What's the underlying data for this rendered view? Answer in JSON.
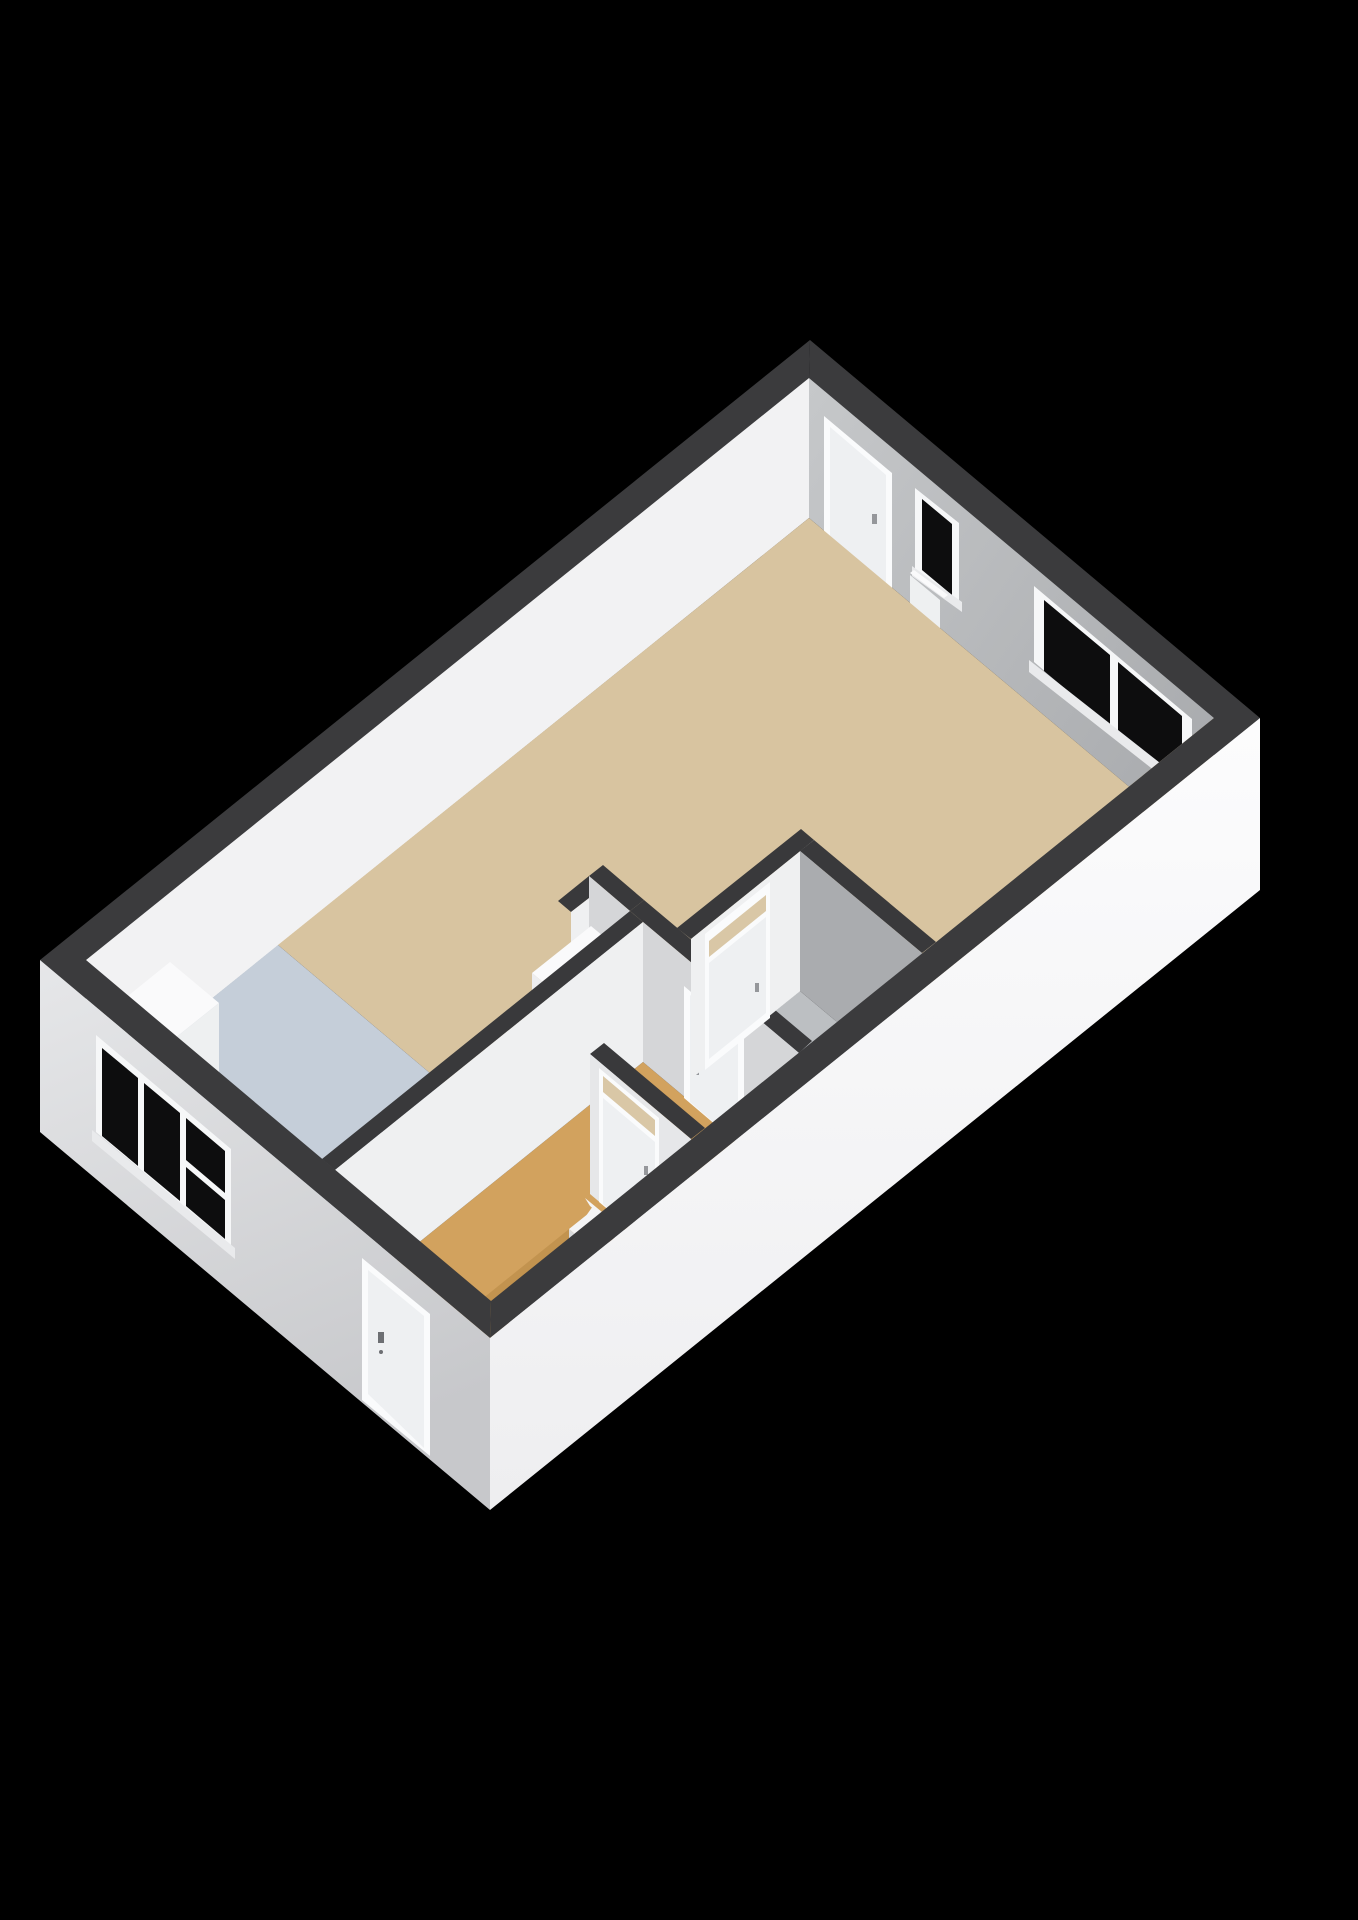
{
  "scene": {
    "type": "3d-floorplan-render",
    "background": "#000000",
    "floors_visible": 1,
    "windows_count": 3,
    "doors_count": 6,
    "transom_doors_count": 2,
    "stair_treads_visible": 7,
    "stair_marker_dots": 2
  },
  "palette": {
    "background": "#000000",
    "wall_top": "#3b3b3d",
    "wall_top_int": "#39393b",
    "nw_inner": "#f2f2f3",
    "ne_inner_light": "#c6c8ca",
    "ne_inner_dark": "#a9abae",
    "se_outer_top": "#fcfcfd",
    "se_outer_bottom": "#eeeef0",
    "sw_outer_top": "#e6e7e9",
    "sw_outer_bottom": "#c7c8cb",
    "int_wall_white": "#eff0f1",
    "int_wall_light": "#e6e7e9",
    "int_wall_side": "#d5d6d8",
    "int_wall_shadow": "#aaacaf",
    "floor_living": "#d8c4a0",
    "floor_kitchen": "#c5ced9",
    "floor_bath": "#bcbfc2",
    "floor_wood": "#d2a25e",
    "floor_wood_dark": "#c2934f",
    "counter_top": "#fafafb",
    "counter_face": "#eef0f1",
    "cabinet_face": "#ededef",
    "stair_white": "#f4f4f5",
    "stair_riser": "#d9dadc",
    "stair_dot": "#b05a20",
    "glass": "#0d0d0e",
    "frame_white": "#f6f7f8",
    "door_panel": "#eef0f2",
    "door_frame": "#fafbfc",
    "transom_glass": "#d9c7a6",
    "handle": "#95979b",
    "handle_dark": "#6d6f73",
    "sill": "#e9eaec"
  }
}
